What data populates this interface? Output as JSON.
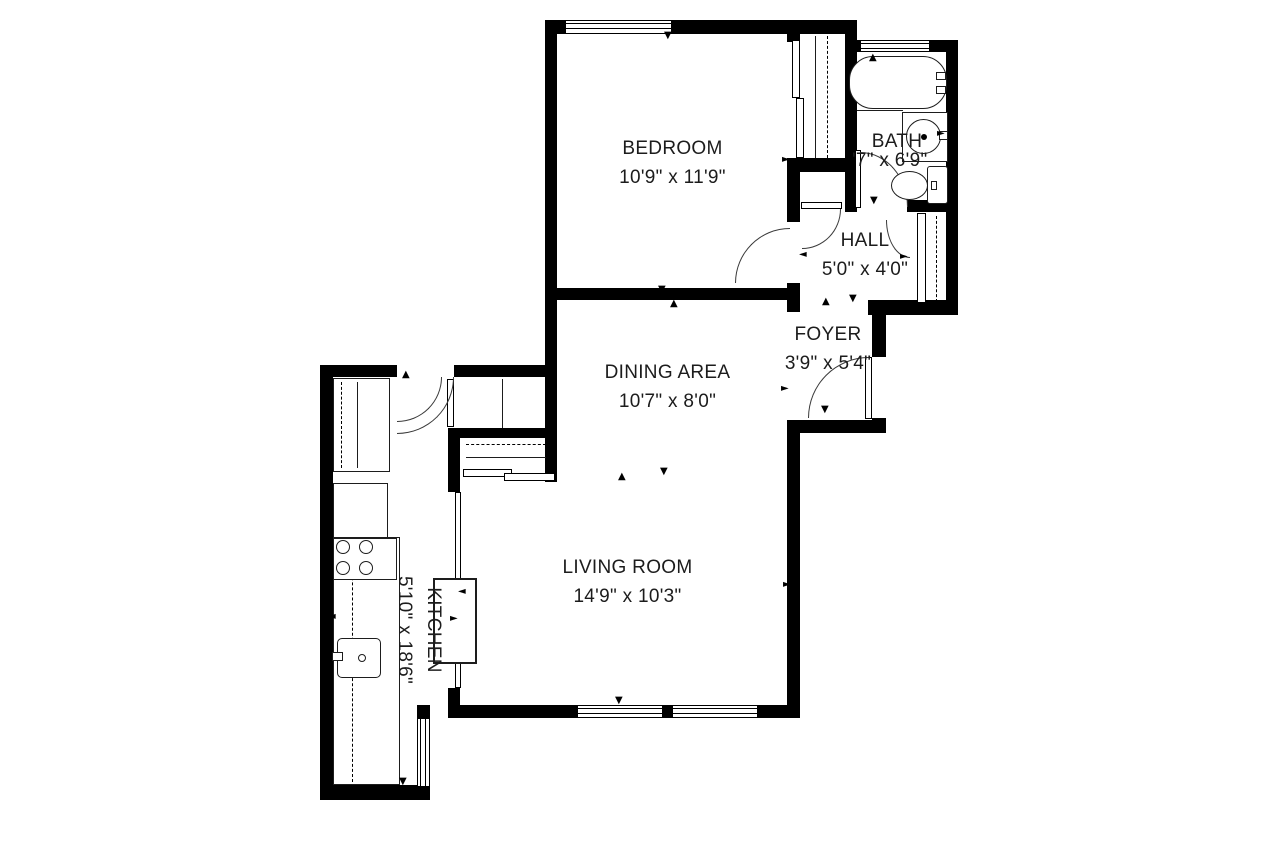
{
  "plan": {
    "title": "Apartment floor plan",
    "rooms": [
      {
        "name": "BEDROOM",
        "dims": "10'9\" x 11'9\""
      },
      {
        "name": "BATH",
        "dims": "'7\" x 6'9\""
      },
      {
        "name": "HALL",
        "dims": "5'0\" x 4'0\""
      },
      {
        "name": "FOYER",
        "dims": "3'9\" x 5'4\""
      },
      {
        "name": "DINING AREA",
        "dims": "10'7\" x 8'0\""
      },
      {
        "name": "LIVING ROOM",
        "dims": "14'9\" x 10'3\""
      },
      {
        "name": "KITCHEN",
        "dims": "5'10\" x 18'6\""
      }
    ],
    "icons": {
      "up": "▲",
      "down": "▼",
      "left": "◄",
      "right": "►"
    },
    "fixtures": [
      "bathtub",
      "bathroom-sink",
      "toilet",
      "stove",
      "kitchen-sink",
      "refrigerator",
      "pantry",
      "kitchen-island",
      "closets-with-rods"
    ],
    "colors": {
      "wall": "#000000",
      "line": "#1d1d1d",
      "background": "#ffffff",
      "text": "#1c1c1c"
    }
  }
}
